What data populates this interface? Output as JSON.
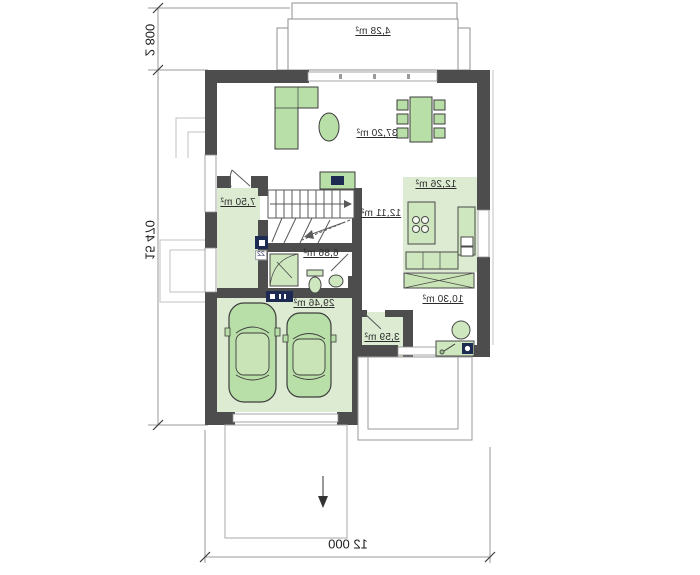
{
  "plan": {
    "rooms": {
      "terrace": {
        "area": "4,28 m²"
      },
      "living_room": {
        "area": "37,20 m²"
      },
      "kitchen": {
        "area": "12,26 m²"
      },
      "hall": {
        "area": "12,11 m²"
      },
      "room_small": {
        "area": "7,50 m²"
      },
      "bathroom": {
        "area": "6,86 m²"
      },
      "garage": {
        "area": "29,46 m²"
      },
      "utility": {
        "area": "10,30 m²"
      },
      "boiler": {
        "area": "3,59 m²"
      }
    },
    "dimensions": {
      "terrace_depth": "2 800",
      "total_height": "15 470",
      "total_width": "12 000"
    },
    "tags": {
      "window_tag": "22"
    },
    "colors": {
      "wall": "#4d4d4d",
      "room_fill": "#dcebd2",
      "furniture_fill": "#b9dfa8",
      "furniture_fill_light": "#cfe7bf",
      "marker_navy": "#1d2b52",
      "line": "#8a8a8a"
    },
    "icons": {
      "stairs_direction": "arrow-right",
      "driveway_direction": "arrow-down"
    }
  }
}
